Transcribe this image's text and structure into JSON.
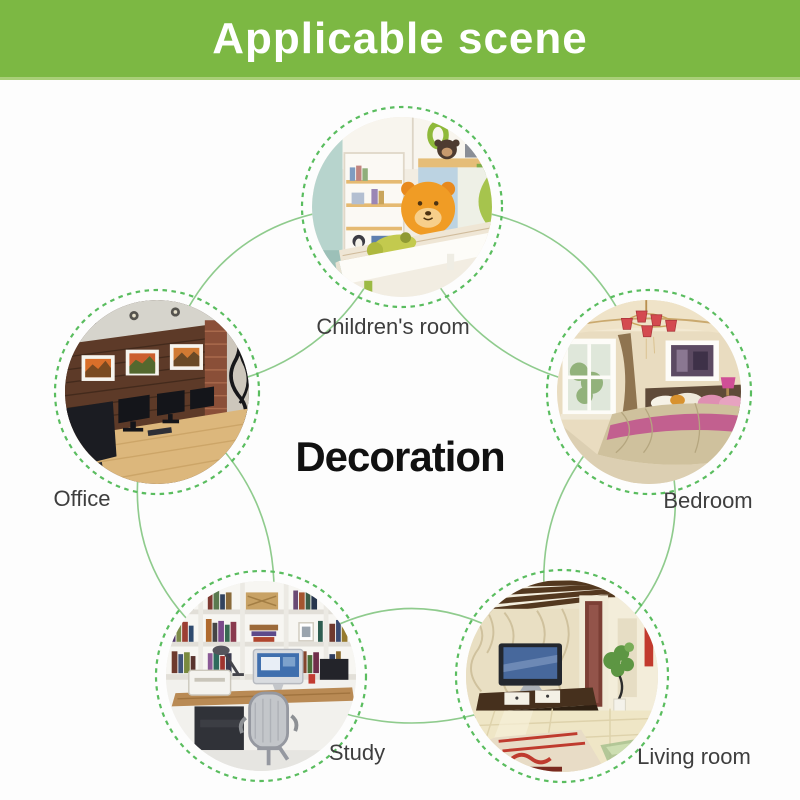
{
  "header": {
    "title": "Applicable scene"
  },
  "center": {
    "label": "Decoration"
  },
  "rooms": [
    {
      "id": "children-room",
      "label": "Children's room"
    },
    {
      "id": "office",
      "label": "Office"
    },
    {
      "id": "bedroom",
      "label": "Bedroom"
    },
    {
      "id": "study",
      "label": "Study"
    },
    {
      "id": "living-room",
      "label": "Living room"
    }
  ],
  "colors": {
    "header-green": "#7cb843",
    "header-edge": "#a9cf78",
    "arc-green": "#8fcb8d",
    "dash-green": "#5abd5f",
    "label-gray": "#3e3e3e",
    "title-black": "#111111",
    "bg": "#fdfdfd"
  }
}
